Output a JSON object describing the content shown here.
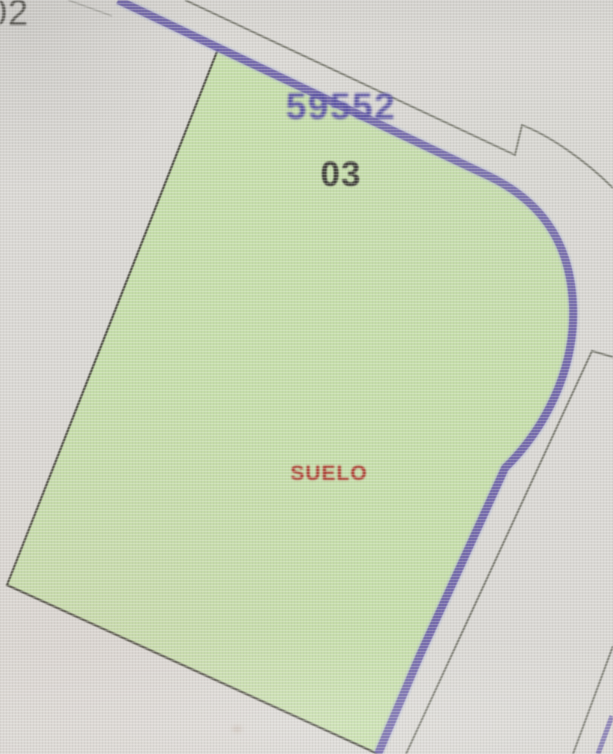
{
  "map": {
    "adjacent_parcel_label": "02",
    "block_label": "59552",
    "parcel_label": "03",
    "land_use_label": "SUELO",
    "colors": {
      "background": "#dbd9d5",
      "parcel_fill": "#c6dfa9",
      "parcel_edge": "#4f4f44",
      "highlight": "#6e61ab",
      "highlight_glow": "#a9b6da",
      "boundary_line": "#6e6e64",
      "block_text": "#5b53a8",
      "parcel_text": "#3f3e38",
      "land_use_text": "#b23a30",
      "adjacent_text": "#5a5852"
    }
  }
}
